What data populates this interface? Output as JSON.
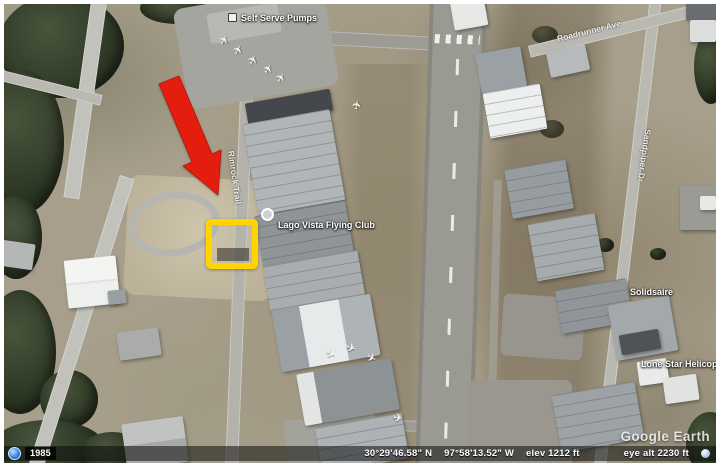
{
  "app": "Google Earth",
  "watermark": "Google Earth",
  "imagery_year": "1985",
  "status_bar": {
    "latitude": "30°29'46.58\" N",
    "longitude": "97°58'13.52\" W",
    "elevation": "elev 1212 ft",
    "eye_altitude": "eye alt  2230 ft"
  },
  "map": {
    "labels": {
      "pumps": "Self Serve Pumps",
      "flying_club": "Lago Vista Flying Club",
      "solidsaire": "Solidsaire",
      "helicopters": "Lone Star Helicopters",
      "road_west": "Rimrock Trail",
      "road_east": "Sandpiper Dr",
      "road_northeast": "Roadrunner Ave"
    }
  },
  "annotations": {
    "arrow_color": "#e41e0f",
    "highlight_color": "#ffd400"
  },
  "icons": {
    "plane": "✈"
  }
}
